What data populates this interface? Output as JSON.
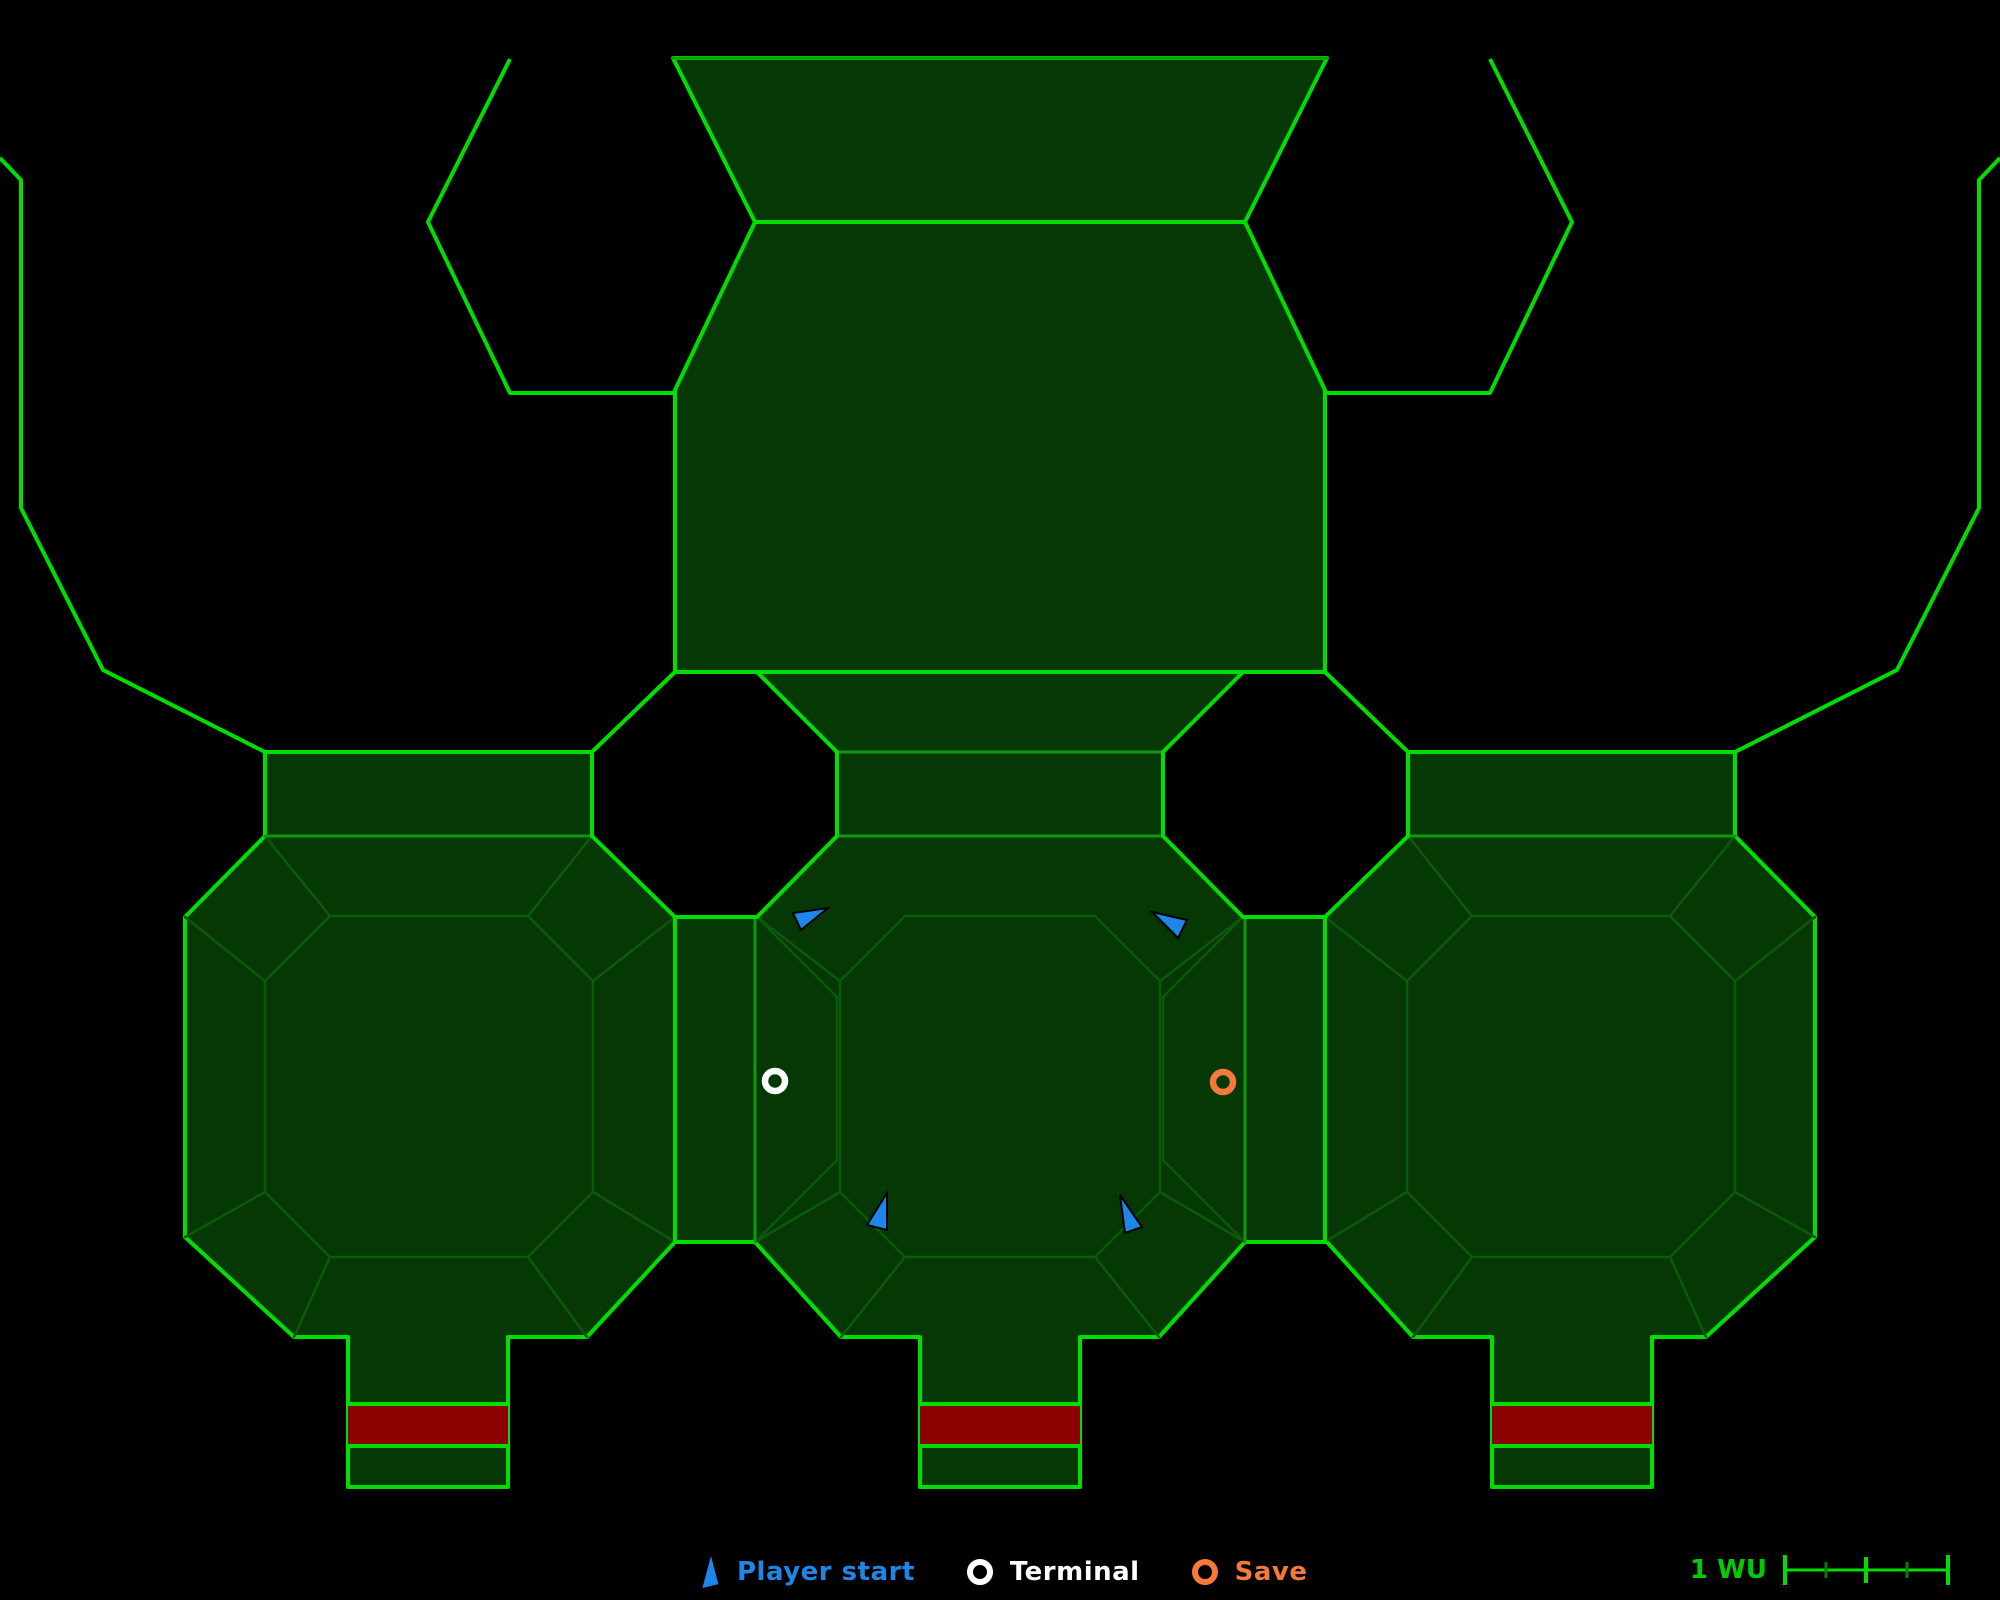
{
  "legend": {
    "items": [
      {
        "name": "player-start",
        "label": "Player start",
        "color": "#1e86e8",
        "marker": "triangle"
      },
      {
        "name": "terminal",
        "label": "Terminal",
        "color": "#ffffff",
        "marker": "ring"
      },
      {
        "name": "save",
        "label": "Save",
        "color": "#f4793b",
        "marker": "ring"
      }
    ]
  },
  "scale_bar": {
    "label": "1 WU",
    "color": "#00cc00",
    "ruler_length": 163,
    "ticks": [
      {
        "x": 0,
        "h": 30,
        "major": true
      },
      {
        "x": 41,
        "h": 16,
        "major": false
      },
      {
        "x": 81,
        "h": 26,
        "major": true
      },
      {
        "x": 122,
        "h": 16,
        "major": false
      },
      {
        "x": 163,
        "h": 30,
        "major": true
      }
    ]
  },
  "map": {
    "colors": {
      "background": "#000000",
      "floor_fill": "#063806",
      "wall_bright": "#00de00",
      "wall_top_edge": "#00a300",
      "line_medium": "#0f990f",
      "line_dim": "#0a5a0a",
      "scale_minor": "#0a7a0a",
      "door_red": "#8b0000",
      "player_blue": "#1e86e8",
      "terminal_white": "#ffffff",
      "save_orange": "#f4793b",
      "marker_outline": "#000000"
    },
    "mass_outline": "673,58 1327,58 1245,222 1325,390 1325,672 1408,752 1735,752 1735,836 1815,917 1815,1237 1706,1337 1652,1337 1652,1487 1492,1487 1492,1337 1413,1337 1327,1242 1245,1242 1159,1337 1080,1337 1080,1487 920,1487 920,1337 841,1337 755,1242 675,1242 587,1337 508,1337 508,1487 348,1487 348,1337 294,1337 185,1237 185,917 265,836 265,752 592,752 675,672 675,390 755,222",
    "holes": [
      "675,672 757,672 837,752 837,836 757,917 675,917 592,836 592,752",
      "1325,672 1243,672 1163,752 1163,836 1243,917 1325,917 1408,836 1408,752"
    ],
    "open_polylines_bright": [
      "510,59 428,222 510,393 675,393",
      "1490,59 1572,222 1490,393 1325,393",
      "0,158 21,180 21,508 103,670 265,752",
      "2000,158 1979,180 1979,508 1897,670 1735,752"
    ],
    "segments_bright": [
      [
        755,
        222,
        1245,
        222
      ],
      [
        675,
        672,
        1325,
        672
      ],
      [
        675,
        917,
        675,
        1242
      ],
      [
        1325,
        917,
        1325,
        1242
      ],
      [
        348,
        1404,
        508,
        1404
      ],
      [
        348,
        1446,
        508,
        1446
      ],
      [
        920,
        1404,
        1080,
        1404
      ],
      [
        920,
        1446,
        1080,
        1446
      ],
      [
        1492,
        1404,
        1652,
        1404
      ],
      [
        1492,
        1446,
        1652,
        1446
      ]
    ],
    "segments_top_edge": [
      [
        673,
        58,
        1327,
        58
      ]
    ],
    "segments_medium": [
      [
        755,
        917,
        755,
        1242
      ],
      [
        1245,
        917,
        1245,
        1242
      ],
      [
        265,
        836,
        592,
        836
      ],
      [
        1408,
        836,
        1735,
        836
      ],
      [
        837,
        752,
        1163,
        752
      ],
      [
        837,
        836,
        1163,
        836
      ]
    ],
    "segments_dim": [
      [
        757,
        917,
        837,
        997
      ],
      [
        837,
        997,
        837,
        1160
      ],
      [
        837,
        1160,
        755,
        1242
      ],
      [
        1243,
        917,
        1163,
        997
      ],
      [
        1163,
        997,
        1163,
        1160
      ],
      [
        1163,
        1160,
        1245,
        1242
      ],
      [
        265,
        836,
        330,
        916
      ],
      [
        592,
        836,
        528,
        916
      ],
      [
        675,
        917,
        593,
        981
      ],
      [
        675,
        1242,
        593,
        1192
      ],
      [
        587,
        1337,
        528,
        1257
      ],
      [
        294,
        1337,
        330,
        1257
      ],
      [
        185,
        1237,
        265,
        1192
      ],
      [
        185,
        917,
        265,
        981
      ],
      [
        757,
        917,
        840,
        981
      ],
      [
        1243,
        917,
        1160,
        981
      ],
      [
        841,
        1337,
        905,
        1257
      ],
      [
        1159,
        1337,
        1095,
        1257
      ],
      [
        755,
        1242,
        840,
        1192
      ],
      [
        1245,
        1242,
        1160,
        1192
      ],
      [
        1735,
        836,
        1670,
        916
      ],
      [
        1408,
        836,
        1472,
        916
      ],
      [
        1325,
        917,
        1407,
        981
      ],
      [
        1325,
        1242,
        1407,
        1192
      ],
      [
        1413,
        1337,
        1472,
        1257
      ],
      [
        1706,
        1337,
        1670,
        1257
      ],
      [
        1815,
        1237,
        1735,
        1192
      ],
      [
        1815,
        917,
        1735,
        981
      ]
    ],
    "inset_octagons": [
      "330,916 528,916 593,981 593,1192 528,1257 330,1257 265,1192 265,981",
      "905,916 1095,916 1160,981 1160,1192 1095,1257 905,1257 840,1192 840,981",
      "1670,916 1472,916 1407,981 1407,1192 1472,1257 1670,1257 1735,1192 1735,981"
    ],
    "doors": [
      {
        "x": 348,
        "y": 1404,
        "w": 160,
        "h": 42
      },
      {
        "x": 920,
        "y": 1404,
        "w": 160,
        "h": 42
      },
      {
        "x": 1492,
        "y": 1404,
        "w": 160,
        "h": 42
      }
    ],
    "player_starts": [
      "793,913 801,930 828,908",
      "1152,912 1187,920 1178,938",
      "887,1193 867,1225 887,1230",
      "1120,1195 1125,1233 1142,1227"
    ],
    "terminals": [
      {
        "x": 775,
        "y": 1081,
        "r": 10
      }
    ],
    "saves": [
      {
        "x": 1223,
        "y": 1082,
        "r": 10
      }
    ]
  }
}
